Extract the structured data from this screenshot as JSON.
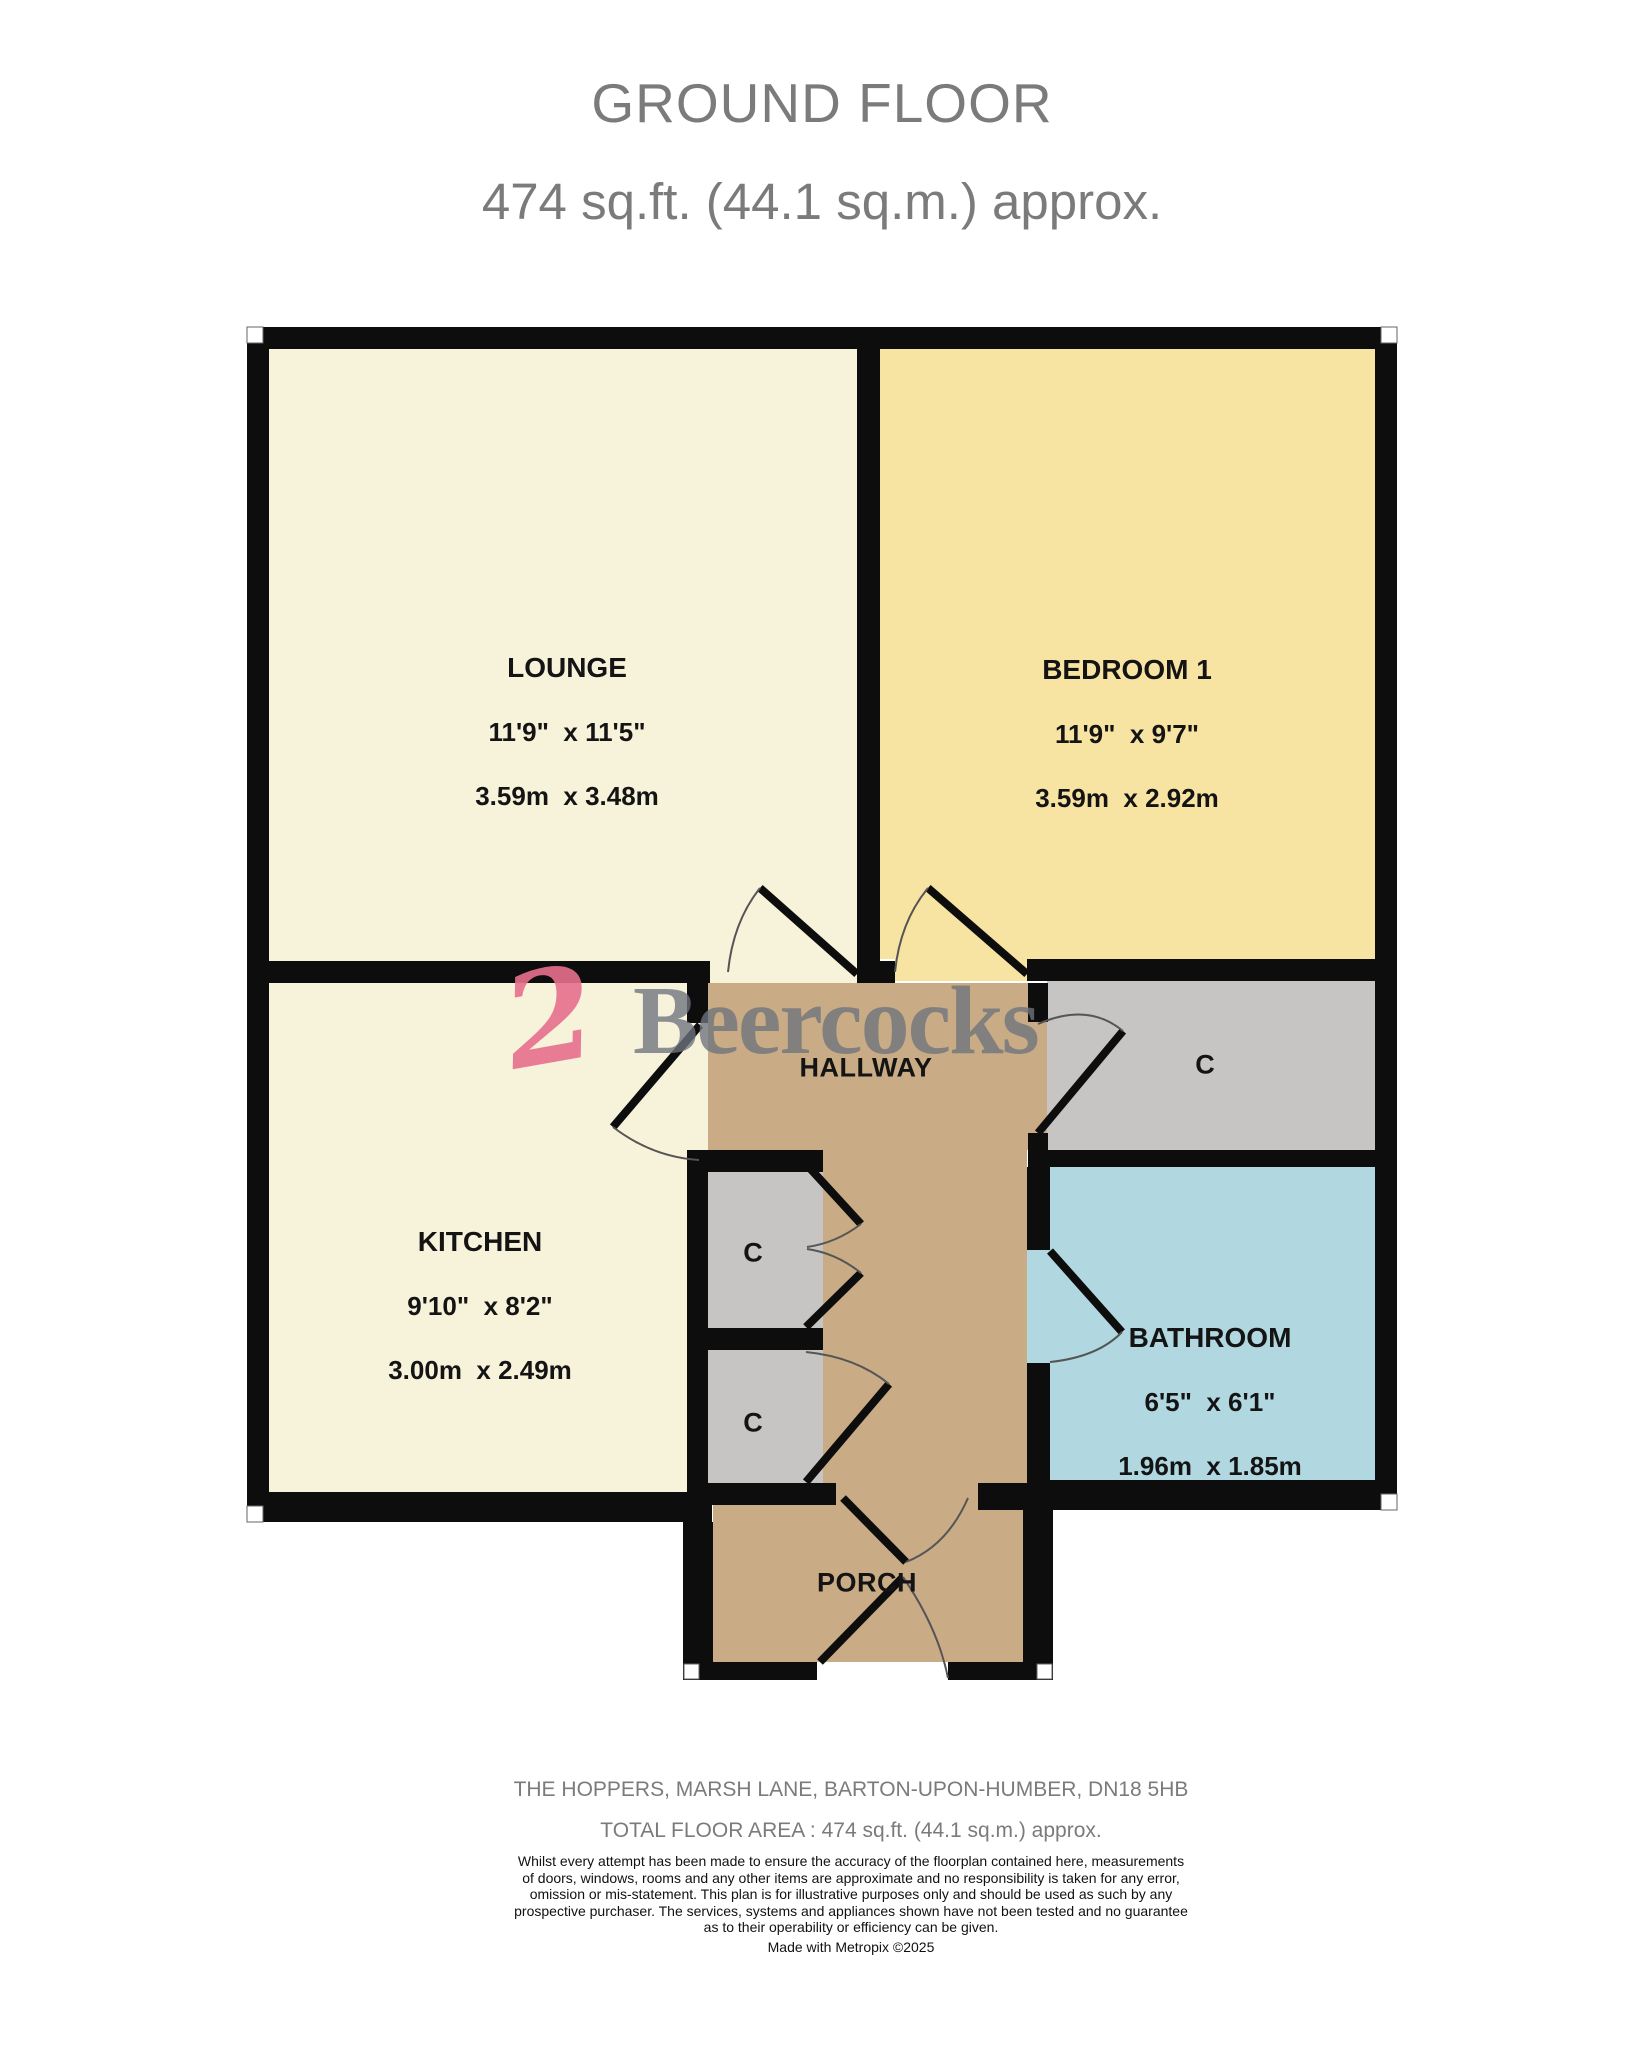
{
  "title": {
    "line1": "GROUND FLOOR",
    "line2": "474 sq.ft. (44.1 sq.m.) approx."
  },
  "rooms": {
    "lounge": {
      "name": "LOUNGE",
      "dims_imperial": "11'9\"  x 11'5\"",
      "dims_metric": "3.59m  x 3.48m"
    },
    "bedroom1": {
      "name": "BEDROOM 1",
      "dims_imperial": "11'9\"  x 9'7\"",
      "dims_metric": "3.59m  x 2.92m"
    },
    "kitchen": {
      "name": "KITCHEN",
      "dims_imperial": "9'10\"  x 8'2\"",
      "dims_metric": "3.00m  x 2.49m"
    },
    "bathroom": {
      "name": "BATHROOM",
      "dims_imperial": "6'5\"  x 6'1\"",
      "dims_metric": "1.96m  x 1.85m"
    },
    "hallway": {
      "name": "HALLWAY"
    },
    "porch": {
      "name": "PORCH"
    },
    "closet_right": {
      "name": "C"
    },
    "closet_upper": {
      "name": "C"
    },
    "closet_lower": {
      "name": "C"
    }
  },
  "watermark": {
    "brand": "Beercocks",
    "mark": "2"
  },
  "footer": {
    "address": "THE HOPPERS, MARSH LANE, BARTON-UPON-HUMBER, DN18 5HB",
    "total_area": "TOTAL FLOOR AREA : 474 sq.ft. (44.1 sq.m.) approx.",
    "disclaimer_lines": [
      "Whilst every attempt has been made to ensure the accuracy of the floorplan contained here, measurements",
      "of doors, windows, rooms and any other items are approximate and no responsibility is taken for any error,",
      "omission or mis-statement. This plan is for illustrative purposes only and should be used as such by any",
      "prospective purchaser. The services, systems and appliances shown have not been tested and no guarantee",
      "as to their operability or efficiency can be given."
    ],
    "credit": "Made with Metropix ©2025"
  },
  "colors": {
    "wall": "#0d0d0d",
    "cream": "#f7f2da",
    "yellow": "#f7e3a2",
    "tan": "#c9ac85",
    "closet_gray": "#c6c5c3",
    "bathroom_blue": "#b1d8e1",
    "door_arc": "#555555",
    "corner_marker": "#ffffff",
    "title_gray": "#7b7b7b",
    "brand_pink": "#e8708e",
    "watermark_gray": "#6f747e"
  }
}
